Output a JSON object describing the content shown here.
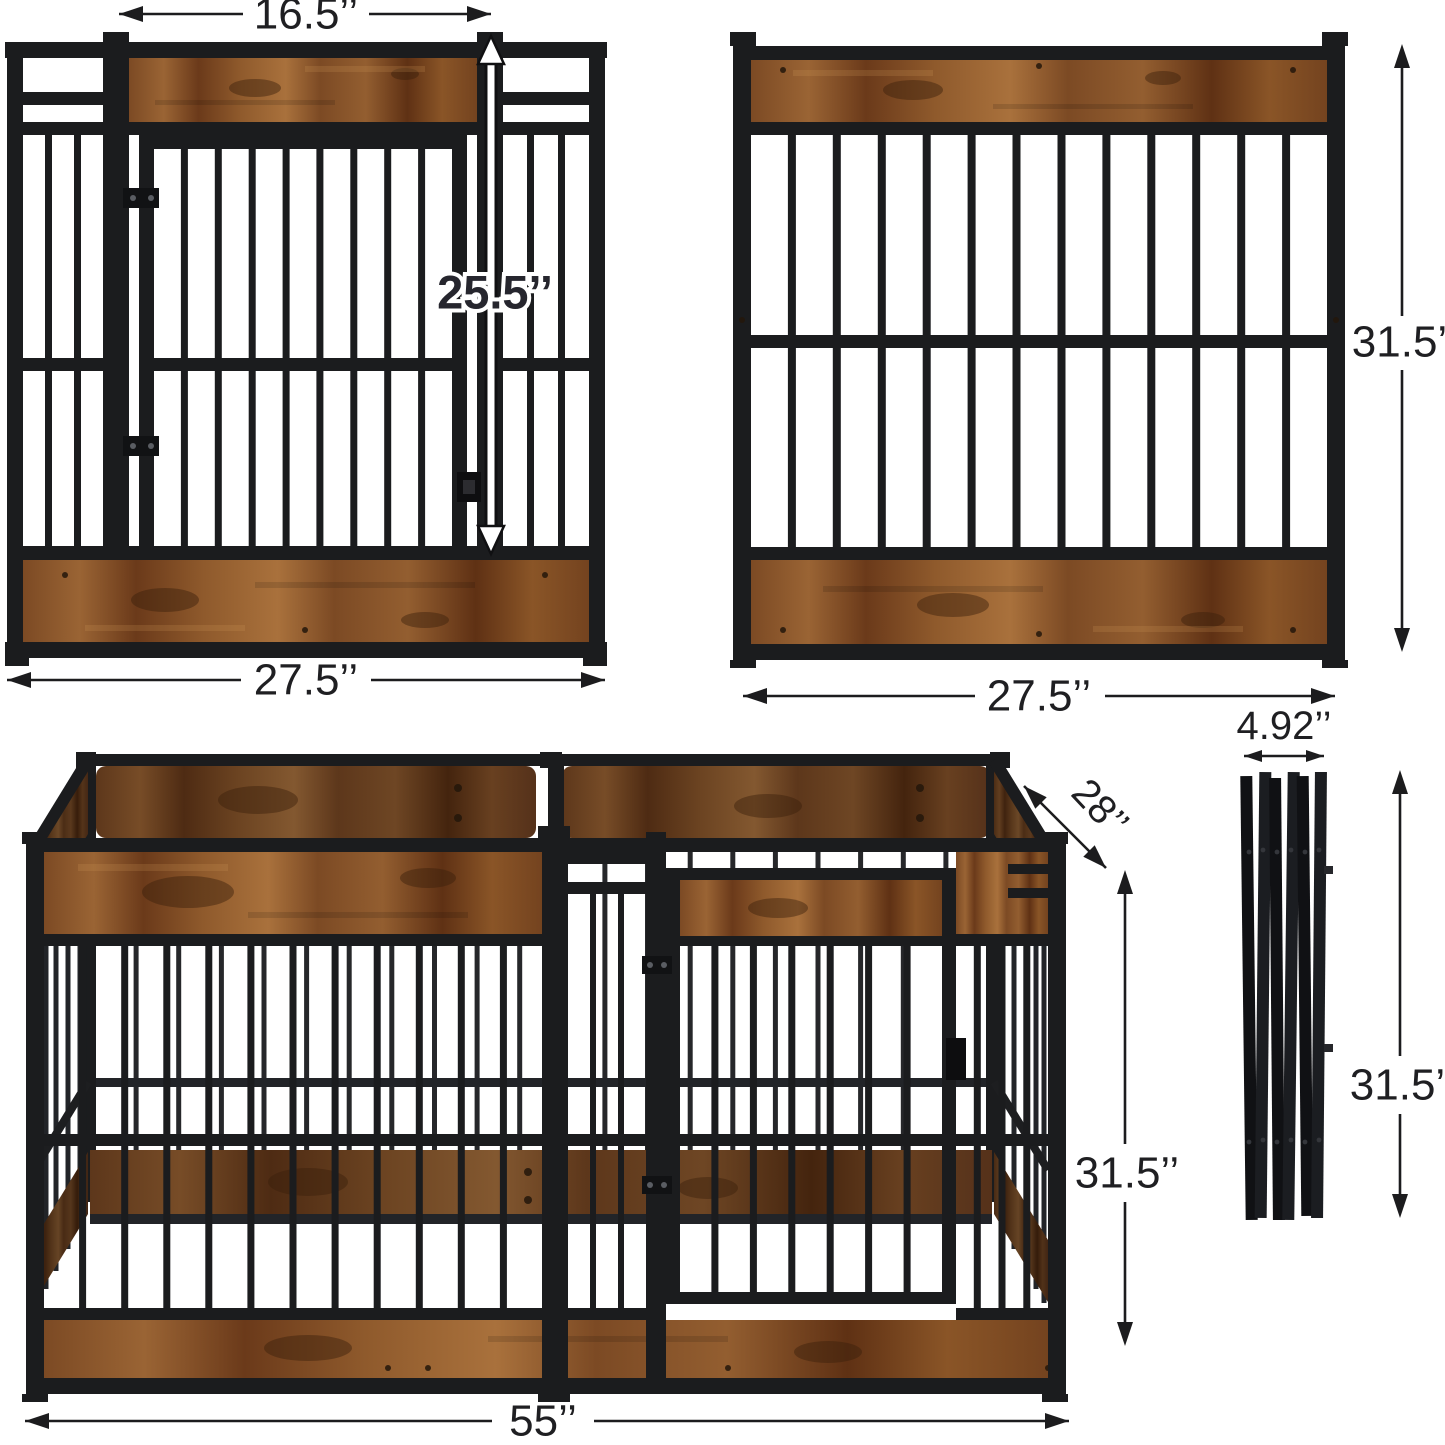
{
  "title": "Heavy-duty wooden dog crate playpen dimension diagram",
  "colors": {
    "metal": "#1b1c1e",
    "wood": "#8a5527",
    "wood_dark": "#5e3418",
    "dimension_text": "#1f1f22",
    "background": "#ffffff"
  },
  "views": {
    "front_panel": {
      "door_width": "16.5’’",
      "door_height": "25.5’’",
      "width": "27.5’’"
    },
    "back_panel": {
      "width": "27.5’’",
      "height": "31.5’’"
    },
    "assembled_pen": {
      "length": "55’’",
      "depth": "28’’",
      "height": "31.5’’"
    },
    "folded_panels": {
      "thickness": "4.92’’",
      "height": "31.5’’"
    }
  }
}
